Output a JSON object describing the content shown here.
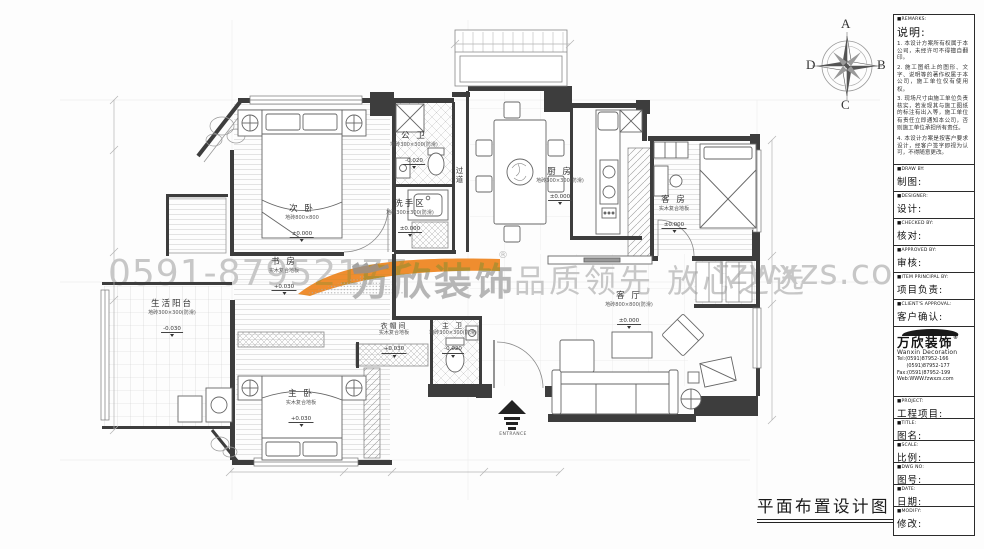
{
  "sheet": {
    "title": "平面布置设计图"
  },
  "watermark": {
    "phone": "0591-87952177",
    "brand": "万欣装饰",
    "reg": "®",
    "slogan": "品质领先 放心之选",
    "site": "fzwxzs.com",
    "orange": "#ef8d2f",
    "gray": "#c7c7c7"
  },
  "compass": {
    "north": "A",
    "east": "B",
    "south": "C",
    "west": "D"
  },
  "rooms": {
    "ciwo": {
      "name": "次 卧",
      "finish": "地砖800×800",
      "level": "±0.000"
    },
    "shufang": {
      "name": "书 房",
      "finish": "实木复合地板",
      "level": "+0.030"
    },
    "zhuwo": {
      "name": "主 卧",
      "finish": "实木复合地板",
      "level": "+0.030"
    },
    "gongwei": {
      "name": "公 卫",
      "finish": "墙砖300×300(防滑)",
      "level": "-0.020"
    },
    "xishouqu": {
      "name": "洗手区",
      "finish": "地砖300×300(防滑)",
      "level": "±0.000"
    },
    "guodao": {
      "name": "过道"
    },
    "chufang": {
      "name": "厨 房",
      "finish": "地砖300×300(防滑)",
      "level": "±0.000"
    },
    "kefang": {
      "name": "客 房",
      "finish": "实木复合地板",
      "level": "±0.000"
    },
    "keting": {
      "name": "客 厅",
      "finish": "地砖800×800(防滑)",
      "level": "±0.000"
    },
    "yimaojian": {
      "name": "衣帽间",
      "finish": "实木复合地板",
      "level": "+0.030"
    },
    "zhuwei": {
      "name": "主 卫",
      "finish": "墙砖300×300(防滑)",
      "level": "-0.020"
    },
    "yangtai": {
      "name": "生活阳台",
      "finish": "地砖300×300(防滑)",
      "level": "-0.030"
    }
  },
  "entrance": {
    "label": "ENTRANCE"
  },
  "titleblock": {
    "notes": {
      "en": "■REMARKS:",
      "cn": "说明:",
      "items": [
        "1. 本设计方案所有权属于本公司，未经许可不得擅自翻印。",
        "2. 施工图纸上的图形、文字、说明等的著作权属于本公司，施工单位仅有使用权。",
        "3. 现场尺寸由施工单位负责核实，若发现其与施工图纸的标注有出入等，施工单位有责任立即通知本公司，否则施工单位承担所有责任。",
        "4. 本设计方案是按客户要求设计，经客户签字即视为认可，不得随意更改。"
      ]
    },
    "rows": [
      {
        "en": "■DRAW BY:",
        "cn": "制图:"
      },
      {
        "en": "■DESIGNER:",
        "cn": "设计:"
      },
      {
        "en": "■CHECKED BY:",
        "cn": "核对:"
      },
      {
        "en": "■APPROVED BY:",
        "cn": "审核:"
      },
      {
        "en": "■ITEM PRINCIPAL BY:",
        "cn": "项目负责:"
      },
      {
        "en": "■CLIENT'S APPROVAL:",
        "cn": "客户确认:"
      }
    ],
    "company": {
      "brand": "万欣装饰",
      "reg": "®",
      "en": "Wanxin Decoration",
      "tel1": "Tel:(0591)87952-166",
      "tel2": "(0591)87952-177",
      "fax": "Fax:(0591)87952-199",
      "web": "Web:WWW.fzwxzs.com"
    },
    "rows2": [
      {
        "en": "■PROJECT:",
        "cn": "工程项目:"
      },
      {
        "en": "■TITLE:",
        "cn": "图名:"
      },
      {
        "en": "■SCALE:",
        "cn": "比例:"
      },
      {
        "en": "■DWG NO:",
        "cn": "图号:"
      },
      {
        "en": "■DATE:",
        "cn": "日期:"
      },
      {
        "en": "■MODIFY:",
        "cn": "修改:"
      }
    ]
  }
}
